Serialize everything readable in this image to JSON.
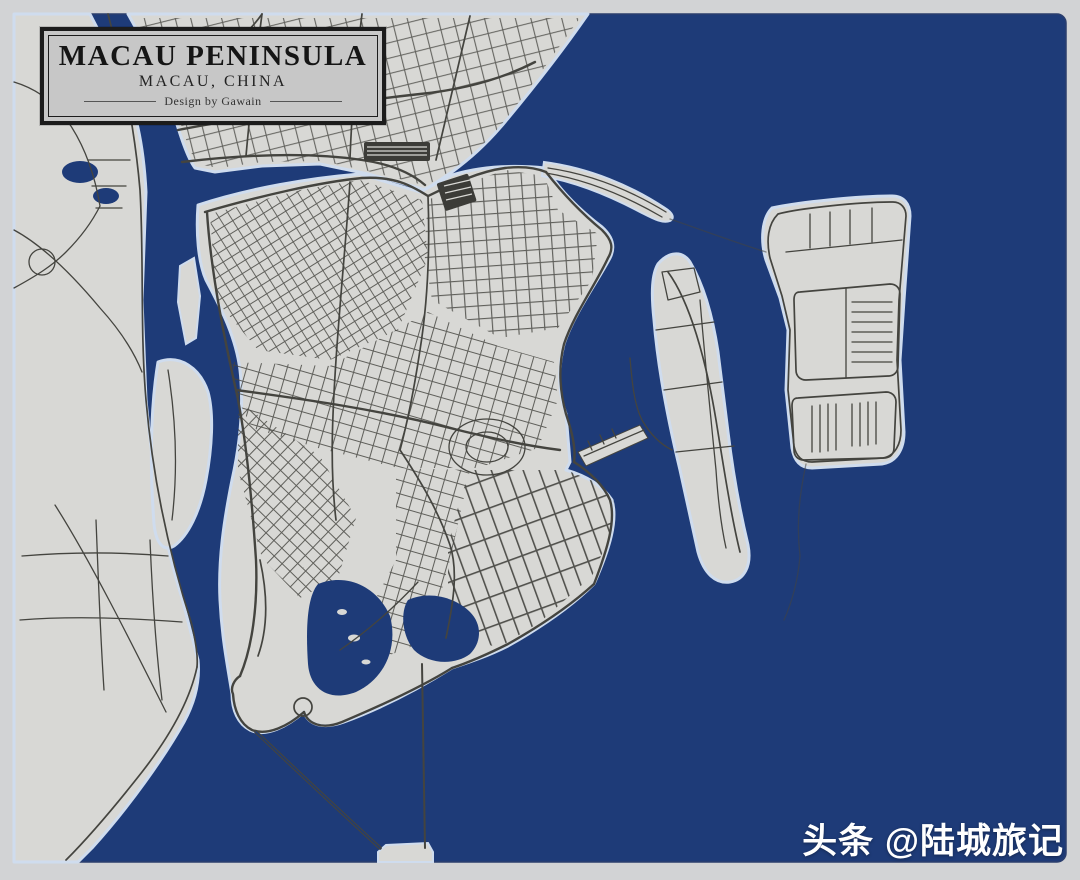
{
  "title_box": {
    "title": "MACAU PENINSULA",
    "subtitle": "MACAU, CHINA",
    "credit": "Design by Gawain"
  },
  "watermark": {
    "text": "头条 @陆城旅记"
  },
  "colors": {
    "margin": "#d2d3d5",
    "water": "#1e3b78",
    "land": "#d8d8d5",
    "halo": "#cfdcee",
    "road": "#44443f",
    "dark_block": "#3c3c38",
    "title_bg": "#c7c7c7",
    "title_border": "#1c1c1c",
    "watermark": "#ffffff"
  }
}
